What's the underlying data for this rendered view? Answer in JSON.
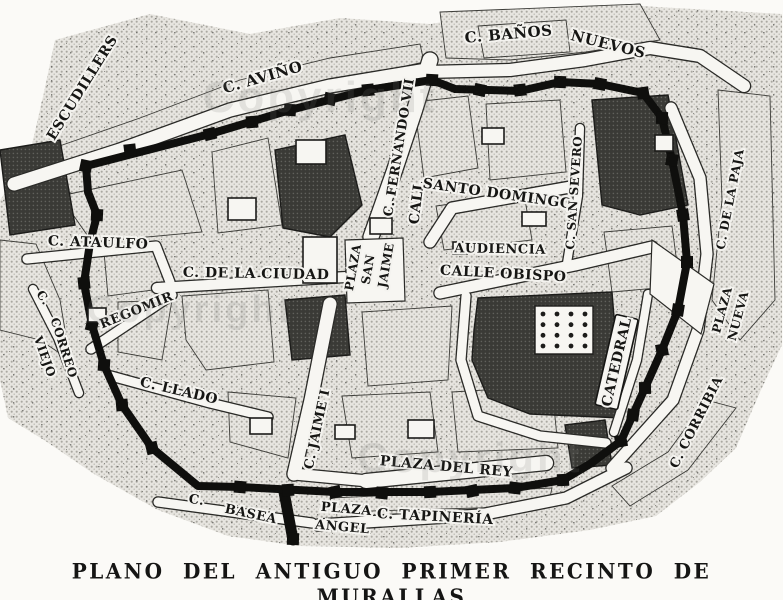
{
  "caption": "PLANO DEL ANTIGUO PRIMER RECINTO DE MURALLAS",
  "colors": {
    "ink": "#141412",
    "paper": "#f7f6f2",
    "halftone_dot": "#a9a7a0",
    "dark_block": "#33332f",
    "wall": "#0f0f0d"
  },
  "map": {
    "labels": [
      {
        "id": "escudillers",
        "text": "ESCUDILLERS",
        "x": 86,
        "y": 90,
        "r": -58,
        "s": 14
      },
      {
        "id": "avino",
        "text": "C. AVIÑO",
        "x": 264,
        "y": 82,
        "r": -16,
        "s": 15
      },
      {
        "id": "banos",
        "text": "C. BAÑOS",
        "x": 509,
        "y": 39,
        "r": -5,
        "s": 15
      },
      {
        "id": "nuevos",
        "text": "NUEVOS",
        "x": 607,
        "y": 49,
        "r": 14,
        "s": 15
      },
      {
        "id": "fernando-vii",
        "text": "C. FERNANDO VII",
        "x": 403,
        "y": 148,
        "r": -81,
        "s": 13
      },
      {
        "id": "call",
        "text": "CALL",
        "x": 421,
        "y": 203,
        "r": -83,
        "s": 14
      },
      {
        "id": "santo-domingo",
        "text": "SANTO DOMINGO",
        "x": 497,
        "y": 198,
        "r": 8,
        "s": 14
      },
      {
        "id": "san-severo",
        "text": "C. SAN SEVERO",
        "x": 578,
        "y": 193,
        "r": -86,
        "s": 12
      },
      {
        "id": "audiencia",
        "text": "AUDIENCIA",
        "x": 500,
        "y": 253,
        "r": 1,
        "s": 13
      },
      {
        "id": "calle-obispo",
        "text": "CALLE OBISPO",
        "x": 503,
        "y": 278,
        "r": 3,
        "s": 14
      },
      {
        "id": "ataulfo",
        "text": "C. ATAULFO",
        "x": 98,
        "y": 247,
        "r": 2,
        "s": 14
      },
      {
        "id": "ciudad",
        "text": "C. DE LA CIUDAD",
        "x": 256,
        "y": 278,
        "r": 1,
        "s": 14
      },
      {
        "id": "plaza-san-jaime-1",
        "text": "PLAZA",
        "x": 357,
        "y": 268,
        "r": -80,
        "s": 12
      },
      {
        "id": "plaza-san-jaime-2",
        "text": "SAN",
        "x": 372,
        "y": 270,
        "r": -80,
        "s": 12
      },
      {
        "id": "plaza-san-jaime-3",
        "text": "JAIME",
        "x": 390,
        "y": 266,
        "r": -80,
        "s": 12
      },
      {
        "id": "correo-c",
        "text": "C.",
        "x": 40,
        "y": 300,
        "r": 55,
        "s": 12
      },
      {
        "id": "correo",
        "text": "CORREO",
        "x": 60,
        "y": 349,
        "r": 72,
        "s": 12
      },
      {
        "id": "viejo",
        "text": "VIEJO",
        "x": 41,
        "y": 358,
        "r": 70,
        "s": 12
      },
      {
        "id": "regomir",
        "text": "REGOMIR",
        "x": 138,
        "y": 314,
        "r": -22,
        "s": 13
      },
      {
        "id": "llado",
        "text": "C. LLADO",
        "x": 178,
        "y": 395,
        "r": 13,
        "s": 14
      },
      {
        "id": "jaime-i",
        "text": "C. JAIME I",
        "x": 321,
        "y": 430,
        "r": -78,
        "s": 13
      },
      {
        "id": "plaza-del-rey",
        "text": "PLAZA DEL REY",
        "x": 446,
        "y": 471,
        "r": 5,
        "s": 14
      },
      {
        "id": "tapineria",
        "text": "C. TAPINERÍA",
        "x": 435,
        "y": 521,
        "r": 3,
        "s": 14
      },
      {
        "id": "plaza-angel-1",
        "text": "PLAZA",
        "x": 346,
        "y": 513,
        "r": 5,
        "s": 13
      },
      {
        "id": "plaza-angel-2",
        "text": "ANGEL",
        "x": 342,
        "y": 531,
        "r": 5,
        "s": 13
      },
      {
        "id": "basea-c",
        "text": "C.",
        "x": 196,
        "y": 504,
        "r": 8,
        "s": 13
      },
      {
        "id": "basea",
        "text": "BASEA",
        "x": 250,
        "y": 518,
        "r": 12,
        "s": 13
      },
      {
        "id": "catedral",
        "text": "CATEDRAL",
        "x": 621,
        "y": 363,
        "r": -77,
        "s": 14,
        "boxed": true
      },
      {
        "id": "corribia",
        "text": "C. CORRIBIA",
        "x": 700,
        "y": 424,
        "r": -63,
        "s": 13
      },
      {
        "id": "plaza-nueva-1",
        "text": "PLAZA",
        "x": 726,
        "y": 311,
        "r": -75,
        "s": 12
      },
      {
        "id": "plaza-nueva-2",
        "text": "NUEVA",
        "x": 742,
        "y": 317,
        "r": -75,
        "s": 12
      },
      {
        "id": "paja",
        "text": "C. DE LA PAJA",
        "x": 734,
        "y": 200,
        "r": -79,
        "s": 12
      }
    ],
    "watermarks": [
      {
        "text": "Copyright",
        "x": 320,
        "y": 112,
        "s": 44
      },
      {
        "text": "Copyright",
        "x": 190,
        "y": 322,
        "s": 38
      },
      {
        "text": "Copyright",
        "x": 470,
        "y": 472,
        "s": 42
      }
    ],
    "base": "M55,40 L150,14 L250,34 L340,18 L430,24 L520,10 L640,6 L782,14 L782,345 L760,392 L736,448 L700,482 L656,516 L590,530 L500,542 L400,548 L300,546 L228,536 L158,510 L94,474 L44,440 L8,418 L0,380 L0,200 L28,162 L44,92 Z",
    "wall": {
      "loop": "M86,166 L210,134 L290,110 L368,90 L432,80 L455,89 L520,91 L560,82 L600,84 L643,93 L662,118 L672,160 L683,215 L687,262 L678,310 L662,350 L645,388 L621,441 L590,464 L563,480 L515,488 L430,492 L335,492 L240,487 L198,486 L152,448 L122,405 L104,365 L92,325 L84,283 L90,243 L97,215 L88,192 Z",
      "stub": "M284,492 L293,540",
      "tower_size": 12,
      "towers": [
        [
          210,
          134
        ],
        [
          252,
          122
        ],
        [
          290,
          110
        ],
        [
          330,
          99
        ],
        [
          368,
          90
        ],
        [
          432,
          80
        ],
        [
          480,
          90
        ],
        [
          520,
          90
        ],
        [
          560,
          82
        ],
        [
          600,
          84
        ],
        [
          643,
          93
        ],
        [
          662,
          118
        ],
        [
          672,
          160
        ],
        [
          683,
          215
        ],
        [
          687,
          262
        ],
        [
          678,
          310
        ],
        [
          662,
          350
        ],
        [
          645,
          388
        ],
        [
          633,
          415
        ],
        [
          621,
          441
        ],
        [
          563,
          480
        ],
        [
          515,
          488
        ],
        [
          472,
          491
        ],
        [
          430,
          492
        ],
        [
          382,
          493
        ],
        [
          335,
          492
        ],
        [
          288,
          490
        ],
        [
          240,
          487
        ],
        [
          152,
          448
        ],
        [
          122,
          405
        ],
        [
          104,
          365
        ],
        [
          92,
          325
        ],
        [
          84,
          283
        ],
        [
          97,
          215
        ],
        [
          86,
          166
        ],
        [
          130,
          150
        ],
        [
          293,
          539
        ]
      ]
    },
    "streets": [
      {
        "d": "M14,184 L120,150 L230,110 L330,86 L426,70",
        "w": 13
      },
      {
        "d": "M426,72 L510,70 L585,60 L650,48 L700,56 L744,86",
        "w": 12
      },
      {
        "d": "M430,60 L414,112 L394,172 L371,237",
        "w": 15
      },
      {
        "d": "M430,242 L452,208 L576,186",
        "w": 11
      },
      {
        "d": "M567,263 L578,196 L580,128",
        "w": 8
      },
      {
        "d": "M440,293 L575,265 L652,247",
        "w": 11
      },
      {
        "d": "M157,288 L346,277",
        "w": 10
      },
      {
        "d": "M330,304 L311,400 L294,474",
        "w": 13
      },
      {
        "d": "M91,349 L172,295",
        "w": 9
      },
      {
        "d": "M33,289 L58,338 L79,393",
        "w": 8
      },
      {
        "d": "M111,376 L210,403 L268,417",
        "w": 9
      },
      {
        "d": "M318,525 L480,515 L566,498 L626,468",
        "w": 11
      },
      {
        "d": "M158,502 L312,523",
        "w": 9
      },
      {
        "d": "M366,481 L546,463",
        "w": 14
      },
      {
        "d": "M27,259 L156,246 L170,282",
        "w": 9
      },
      {
        "d": "M612,468 L673,400 L698,330 L707,254 L700,178 L671,108",
        "w": 11
      },
      {
        "d": "M294,474 L368,481",
        "w": 11
      },
      {
        "d": "M466,296 L461,360 L478,416 L540,436 L606,443",
        "w": 9
      },
      {
        "d": "M648,294 L637,360 L614,432",
        "w": 8
      }
    ],
    "plazas": [
      {
        "d": "M345,240 L403,238 L405,301 L347,303 Z"
      },
      {
        "d": "M652,240 L714,284 L701,334 L650,294 Z"
      }
    ],
    "blocks": [
      {
        "d": "M48,150 L140,118 L240,80 L330,58 L420,44 L424,62 L236,104 L126,146 L52,170 Z",
        "shade": "light"
      },
      {
        "d": "M440,12 L640,4 L660,40 L586,52 L510,60 L446,58 Z",
        "shade": "light"
      },
      {
        "d": "M60,196 L182,170 L202,232 L92,242 Z",
        "shade": "light"
      },
      {
        "d": "M212,152 L268,138 L282,225 L218,233 Z",
        "shade": "light"
      },
      {
        "d": "M104,252 L162,247 L168,288 L108,296 Z",
        "shade": "light"
      },
      {
        "d": "M182,296 L268,290 L274,362 L206,370 L186,340 Z",
        "shade": "light"
      },
      {
        "d": "M118,302 L172,300 L162,360 L118,352 Z",
        "shade": "light"
      },
      {
        "d": "M228,392 L296,398 L288,458 L230,442 Z",
        "shade": "light"
      },
      {
        "d": "M362,312 L452,306 L448,380 L368,386 Z",
        "shade": "light"
      },
      {
        "d": "M414,102 L468,96 L478,168 L424,178 Z",
        "shade": "light"
      },
      {
        "d": "M486,104 L560,100 L566,172 L490,180 Z",
        "shade": "light"
      },
      {
        "d": "M436,206 L524,194 L532,240 L444,250 Z",
        "shade": "light"
      },
      {
        "d": "M604,232 L672,226 L680,286 L612,292 Z",
        "shade": "light"
      },
      {
        "d": "M342,396 L430,392 L438,452 L352,458 Z",
        "shade": "light"
      },
      {
        "d": "M452,392 L552,386 L558,448 L458,452 Z",
        "shade": "light"
      },
      {
        "d": "M478,26 L566,20 L570,52 L484,58 Z",
        "shade": "light"
      },
      {
        "d": "M612,486 L668,452 L706,400 L736,408 L688,470 L630,506 Z",
        "shade": "light"
      },
      {
        "d": "M330,498 L552,488 L548,506 L334,512 Z",
        "shade": "light"
      },
      {
        "d": "M718,90 L770,96 L775,300 L740,340 L712,300 L722,200 Z",
        "shade": "light"
      },
      {
        "d": "M0,240 L36,244 L60,300 L70,360 L40,340 L0,330 Z",
        "shade": "light"
      },
      {
        "d": "M275,150 L345,135 L362,205 L330,237 L283,228 Z",
        "shade": "dark"
      },
      {
        "d": "M478,298 L612,292 L622,418 L530,414 L488,398 L472,360 L474,330 Z",
        "shade": "dark"
      },
      {
        "d": "M592,100 L668,95 L688,205 L640,215 L602,205 Z",
        "shade": "dark"
      },
      {
        "d": "M285,300 L345,295 L350,355 L292,360 Z",
        "shade": "dark"
      },
      {
        "d": "M565,425 L605,420 L612,465 L572,468 Z",
        "shade": "dark"
      },
      {
        "d": "M0,150 L60,140 L75,225 L10,235 Z",
        "shade": "dark"
      }
    ],
    "buildings": [
      [
        303,
        237,
        34,
        46
      ],
      [
        228,
        198,
        28,
        22
      ],
      [
        370,
        218,
        22,
        16
      ],
      [
        482,
        128,
        22,
        16
      ],
      [
        522,
        212,
        24,
        14
      ],
      [
        88,
        308,
        18,
        14
      ],
      [
        250,
        418,
        22,
        16
      ],
      [
        408,
        420,
        26,
        18
      ],
      [
        655,
        135,
        18,
        16
      ],
      [
        296,
        140,
        30,
        24
      ],
      [
        453,
        242,
        14,
        12
      ],
      [
        335,
        425,
        20,
        14
      ]
    ],
    "cloister": {
      "x": 535,
      "y": 306,
      "w": 58,
      "h": 48,
      "cols": 4,
      "rows": 4
    }
  }
}
